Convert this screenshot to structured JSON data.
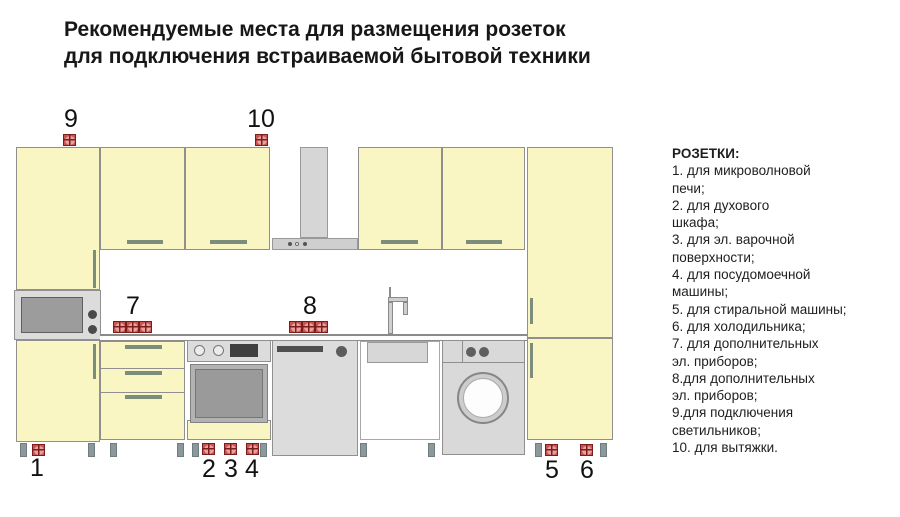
{
  "title": {
    "line1": "Рекомендуемые места для размещения розеток",
    "line2": "для подключения встраиваемой бытовой техники"
  },
  "legend": {
    "heading": "РОЗЕТКИ:",
    "lines": [
      "1. для микроволновой",
      "печи;",
      "2. для духового",
      "шкафа;",
      "3. для эл. варочной",
      "поверхности;",
      "4. для посудомоечной",
      "машины;",
      "5. для стиральной машины;",
      "6. для холодильника;",
      "7. для дополнительных",
      "эл. приборов;",
      "8.для дополнительных",
      "эл. приборов;",
      "9.для подключения",
      "светильников;",
      "10. для вытяжки."
    ]
  },
  "markers": {
    "labels": [
      "1",
      "2",
      "3",
      "4",
      "5",
      "6",
      "7",
      "8",
      "9",
      "10"
    ]
  },
  "colors": {
    "cabinet": "#f9f6c4",
    "appliance": "#dcdcdc",
    "handle": "#7d8d7c",
    "outlet_border": "#7c1d1d",
    "outlet_fill": "#c9534f",
    "outlet_circle": "#e8a19e"
  }
}
